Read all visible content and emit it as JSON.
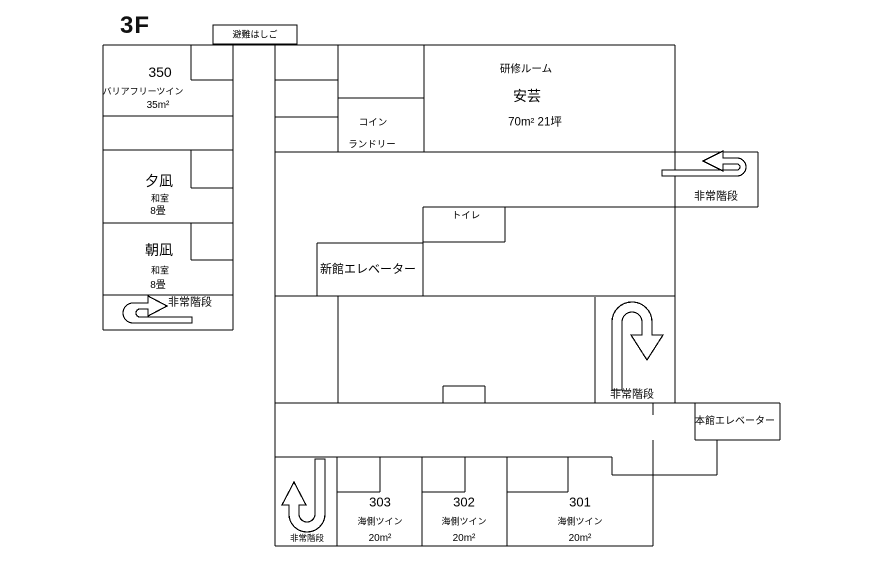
{
  "floor_title": "3F",
  "labels": {
    "escape_hatch": "避難はしご",
    "emergency_stairs": "非常階段",
    "coin_laundry_line1": "コイン",
    "coin_laundry_line2": "ランドリー",
    "toilet": "トイレ",
    "new_wing_elevator": "新館エレベーター",
    "main_wing_elevator": "本館エレベーター"
  },
  "rooms": {
    "r350": {
      "number": "350",
      "type": "バリアフリーツイン",
      "size": "35m²"
    },
    "yunagi": {
      "name": "夕凪",
      "type": "和室",
      "size": "8畳"
    },
    "asanagi": {
      "name": "朝凪",
      "type": "和室",
      "size": "8畳"
    },
    "training": {
      "label": "研修ルーム",
      "name": "安芸",
      "size": "70m²  21坪"
    },
    "r303": {
      "number": "303",
      "type": "海側ツイン",
      "size": "20m²"
    },
    "r302": {
      "number": "302",
      "type": "海側ツイン",
      "size": "20m²"
    },
    "r301": {
      "number": "301",
      "type": "海側ツイン",
      "size": "20m²"
    }
  }
}
